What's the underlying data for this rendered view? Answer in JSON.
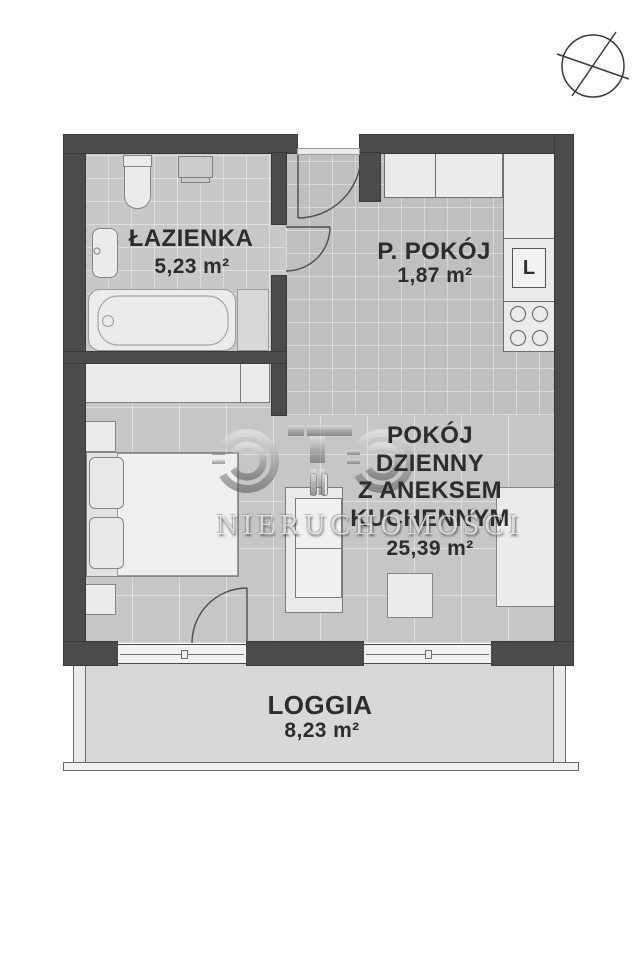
{
  "watermark": {
    "logo": "OTO",
    "brand": "NIERUCHOMOŚCI"
  },
  "rooms": {
    "bathroom": {
      "name": "ŁAZIENKA",
      "area": "5,23 m²"
    },
    "hall": {
      "name": "P. POKÓJ",
      "area": "1,87 m²"
    },
    "living": {
      "name_lines": [
        "POKÓJ",
        "DZIENNY",
        "Z ANEKSEM",
        "KUCHENNYM"
      ],
      "area": "25,39 m²"
    },
    "loggia": {
      "name": "LOGGIA",
      "area": "8,23 m²"
    }
  },
  "kitchen": {
    "fridge_label": "L"
  },
  "icons": {
    "compass": "compass-rose-icon"
  },
  "colors": {
    "wall": "#4b4a4c",
    "bathroom_floor": "#c8c8ca",
    "hall_floor": "#bfbfc1",
    "living_floor": "#c6c6c8",
    "loggia_floor": "#dad8d6",
    "furniture": "#ebebe9"
  }
}
